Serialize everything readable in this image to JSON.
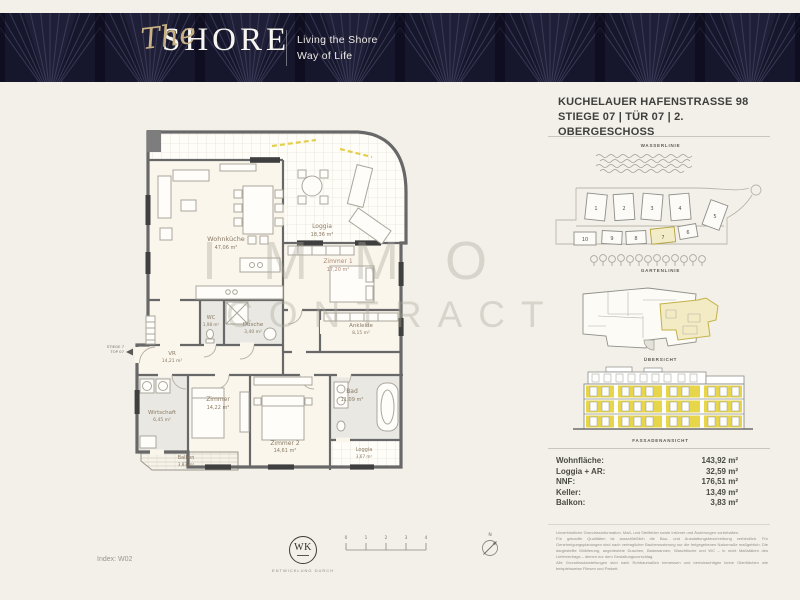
{
  "colors": {
    "navy": "#16162c",
    "gold": "#c8b184",
    "accent_yellow": "#e7d64b",
    "wall_gray": "#686868"
  },
  "header": {
    "brand_script": "The",
    "brand_name": "SHORE",
    "tagline_line1": "Living the Shore",
    "tagline_line2": "Way of Life"
  },
  "title": {
    "line1": "KUCHELAUER HAFENSTRASSE 98",
    "line2": "STIEGE 07 | TÜR 07 | 2. OBERGESCHOSS"
  },
  "side": {
    "wasserlinie_label": "WASSERLINIE",
    "gartenlinie_label": "GARTENLINIE",
    "uebersicht_label": "ÜBERSICHT",
    "fassade_label": "FASSADENANSICHT",
    "site_buildings": [
      "1",
      "2",
      "3",
      "4",
      "5",
      "6",
      "7",
      "8",
      "9",
      "10"
    ],
    "highlighted_building": "7"
  },
  "floorplan": {
    "entrance_line1": "STIEGE 7",
    "entrance_line2": "TOP 07",
    "watermark_line1": "IMMO",
    "watermark_line2": "CONTRACT",
    "rooms": [
      {
        "name": "Wohnküche",
        "area": "47,06 m²"
      },
      {
        "name": "Loggia",
        "area": "18,36 m²"
      },
      {
        "name": "Zimmer 1",
        "area": "17,20 m²"
      },
      {
        "name": "WC",
        "area": "1,98 m²"
      },
      {
        "name": "Dusche",
        "area": "3,40 m²"
      },
      {
        "name": "Ankleide",
        "area": "8,15 m²"
      },
      {
        "name": "VR",
        "area": "14,21 m²"
      },
      {
        "name": "Wirtschaft",
        "area": "6,45 m²"
      },
      {
        "name": "Zimmer",
        "area": "14,22 m²"
      },
      {
        "name": "Zimmer 2",
        "area": "14,61 m²"
      },
      {
        "name": "Bad",
        "area": "11,09 m²"
      },
      {
        "name": "Loggia",
        "area": "3,67 m²"
      },
      {
        "name": "Balkon",
        "area": "3,83 m²"
      }
    ]
  },
  "areas": {
    "rows": [
      {
        "label": "Wohnfläche:",
        "value": "143,92 m²"
      },
      {
        "label": "Loggia + AR:",
        "value": "32,59 m²"
      },
      {
        "label": "NNF:",
        "value": "176,51 m²"
      },
      {
        "label": "Keller:",
        "value": "13,49 m²"
      },
      {
        "label": "Balkon:",
        "value": "3,83 m²"
      }
    ]
  },
  "disclaimer": {
    "lines": [
      "Unverbindliche Grundrissinformation. Maß- und Stellfehler sowie Irrtümer und Änderungen vorbehalten.",
      "Für gekaufte Qualitäten ist ausschließlich die Bau- und Ausstattungsbeschreibung verbindlich. Für Genehmigungsplanungen sind nach vertraglicher Baubemusterung nur die freigegebenen Naturmaße maßgeblich. Die dargestellte Möblierung, angedeutete Duschen, Badewannen, Waschtische und WC – in nicht Maßstäben des Liefervertrags – dienen nur dem Gestaltungsvorschlag.",
      "Alle Grundrissdarstellungen sind nach Rohbaumaßen bemessen und berücksichtigen keine Oberflächen wie beispielsweise Fliesen und Parkett."
    ]
  },
  "footer": {
    "index_label": "Index: W02",
    "logo_text": "WK",
    "logo_caption": "ENTWICKLUNG DURCH",
    "scale_ticks": [
      "0",
      "1",
      "2",
      "3",
      "4"
    ],
    "north_label": "N"
  }
}
